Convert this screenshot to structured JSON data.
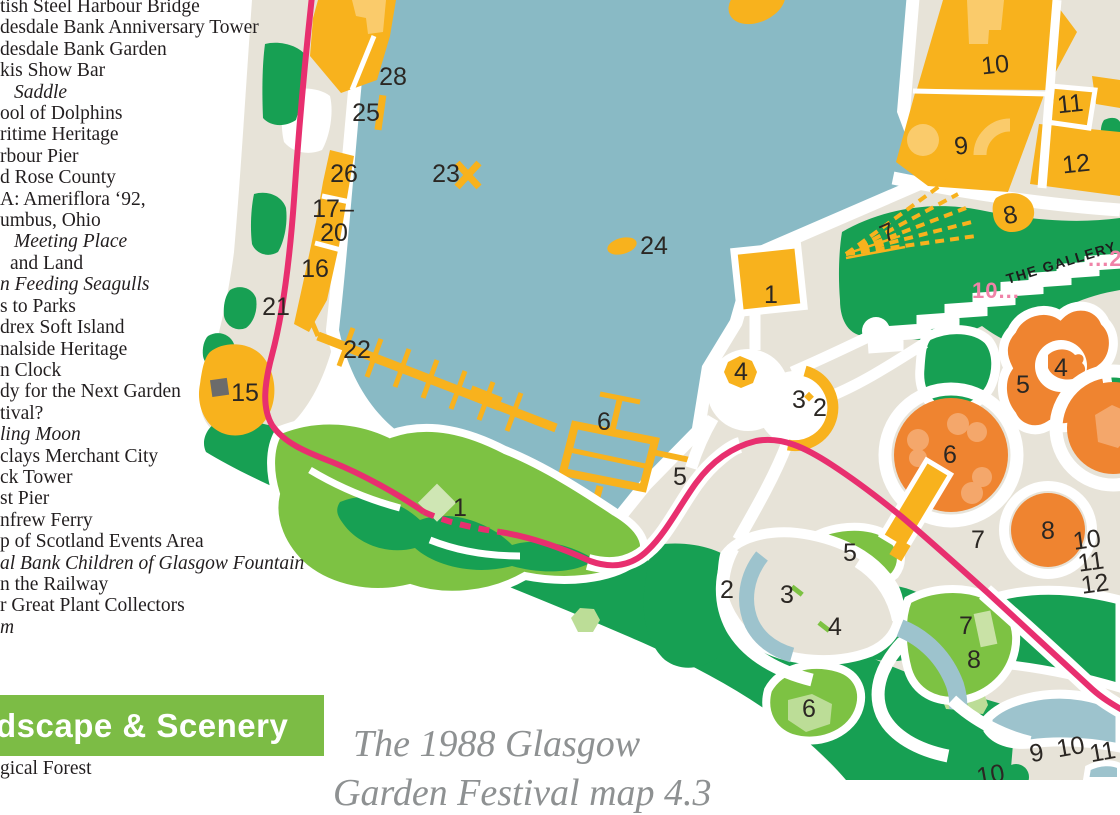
{
  "legend": {
    "items": [
      {
        "text": "tish Steel Harbour Bridge",
        "italic": false,
        "indent": 0
      },
      {
        "text": "desdale Bank Anniversary Tower",
        "italic": false,
        "indent": 0
      },
      {
        "text": "desdale Bank Garden",
        "italic": false,
        "indent": 0
      },
      {
        "text": "kis Show Bar",
        "italic": false,
        "indent": 0
      },
      {
        "text": "Saddle",
        "italic": true,
        "indent": 14
      },
      {
        "text": "ool of Dolphins",
        "italic": false,
        "indent": 0
      },
      {
        "text": "ritime Heritage",
        "italic": false,
        "indent": 0
      },
      {
        "text": "rbour Pier",
        "italic": false,
        "indent": 0
      },
      {
        "text": "d Rose County",
        "italic": false,
        "indent": 0
      },
      {
        "text": "A: Ameriflora ‘92,",
        "italic": false,
        "indent": 0
      },
      {
        "text": "umbus, Ohio",
        "italic": false,
        "indent": 0
      },
      {
        "text": "Meeting Place",
        "italic": true,
        "indent": 14
      },
      {
        "text": "and Land",
        "italic": false,
        "indent": 10
      },
      {
        "text": "n Feeding Seagulls",
        "italic": true,
        "indent": 0
      },
      {
        "text": "s to Parks",
        "italic": false,
        "indent": 0
      },
      {
        "text": "drex Soft Island",
        "italic": false,
        "indent": 0
      },
      {
        "text": "nalside Heritage",
        "italic": false,
        "indent": 0
      },
      {
        "text": "n Clock",
        "italic": false,
        "indent": 0
      },
      {
        "text": "dy for the Next Garden",
        "italic": false,
        "indent": 0
      },
      {
        "text": "tival?",
        "italic": false,
        "indent": 0
      },
      {
        "text": "ling Moon",
        "italic": true,
        "indent": 0
      },
      {
        "text": "clays Merchant City",
        "italic": false,
        "indent": 0
      },
      {
        "text": "ck Tower",
        "italic": false,
        "indent": 0
      },
      {
        "text": "st Pier",
        "italic": false,
        "indent": 0
      },
      {
        "text": "nfrew Ferry",
        "italic": false,
        "indent": 0
      },
      {
        "text": "p of Scotland Events Area",
        "italic": false,
        "indent": 0
      },
      {
        "text": "al Bank Children of Glasgow Fountain",
        "italic": true,
        "indent": 0
      },
      {
        "text": "n the Railway",
        "italic": false,
        "indent": 0
      },
      {
        "text": "r Great Plant Collectors",
        "italic": false,
        "indent": 0
      },
      {
        "text": "m",
        "italic": true,
        "indent": 0
      }
    ],
    "section_header": "dscape & Scenery",
    "below_item": "gical Forest"
  },
  "caption": {
    "line1": "The 1988 Glasgow",
    "line2": "Garden Festival map 4.3"
  },
  "map": {
    "texts": {
      "gallery": "THE GALLERY",
      "pink_left": "10...",
      "pink_right": "...25"
    },
    "labels": [
      {
        "t": "28",
        "x": 393,
        "y": 85,
        "r": 0
      },
      {
        "t": "25",
        "x": 366,
        "y": 121,
        "r": 0
      },
      {
        "t": "26",
        "x": 344,
        "y": 182,
        "r": 0
      },
      {
        "t": "17–",
        "x": 333,
        "y": 217,
        "r": 0
      },
      {
        "t": "20",
        "x": 334,
        "y": 241,
        "r": 0
      },
      {
        "t": "16",
        "x": 315,
        "y": 277,
        "r": 0
      },
      {
        "t": "21",
        "x": 276,
        "y": 315,
        "r": 0
      },
      {
        "t": "22",
        "x": 357,
        "y": 358,
        "r": 0
      },
      {
        "t": "15",
        "x": 245,
        "y": 401,
        "r": 0
      },
      {
        "t": "23",
        "x": 446,
        "y": 182,
        "r": 0
      },
      {
        "t": "24",
        "x": 654,
        "y": 254,
        "r": 0
      },
      {
        "t": "1",
        "x": 771,
        "y": 303,
        "r": 0
      },
      {
        "t": "4",
        "x": 741,
        "y": 380,
        "r": 0
      },
      {
        "t": "3",
        "x": 799,
        "y": 408,
        "r": 0
      },
      {
        "t": "2",
        "x": 820,
        "y": 416,
        "r": 0
      },
      {
        "t": "5",
        "x": 680,
        "y": 485,
        "r": 0
      },
      {
        "t": "6",
        "x": 604,
        "y": 430,
        "r": 0
      },
      {
        "t": "1",
        "x": 460,
        "y": 516,
        "r": 0
      },
      {
        "t": "7",
        "x": 891,
        "y": 240,
        "r": -24
      },
      {
        "t": "8",
        "x": 1012,
        "y": 223,
        "r": -12
      },
      {
        "t": "10",
        "x": 996,
        "y": 73,
        "r": -6
      },
      {
        "t": "9",
        "x": 962,
        "y": 154,
        "r": -6
      },
      {
        "t": "11",
        "x": 1071,
        "y": 112,
        "r": -6
      },
      {
        "t": "12",
        "x": 1077,
        "y": 172,
        "r": -6
      },
      {
        "t": "5",
        "x": 1023,
        "y": 393,
        "r": 0
      },
      {
        "t": "4",
        "x": 1061,
        "y": 376,
        "r": 0
      },
      {
        "t": "6",
        "x": 950,
        "y": 463,
        "r": 0
      },
      {
        "t": "8",
        "x": 1048,
        "y": 539,
        "r": 0
      },
      {
        "t": "7",
        "x": 978,
        "y": 548,
        "r": 0
      },
      {
        "t": "10",
        "x": 1088,
        "y": 548,
        "r": -8
      },
      {
        "t": "11",
        "x": 1092,
        "y": 570,
        "r": -8
      },
      {
        "t": "12",
        "x": 1096,
        "y": 592,
        "r": -8
      },
      {
        "t": "2",
        "x": 727,
        "y": 598,
        "r": 0
      },
      {
        "t": "3",
        "x": 787,
        "y": 603,
        "r": 0
      },
      {
        "t": "4",
        "x": 835,
        "y": 635,
        "r": 0
      },
      {
        "t": "5",
        "x": 850,
        "y": 561,
        "r": 0
      },
      {
        "t": "6",
        "x": 809,
        "y": 717,
        "r": 0
      },
      {
        "t": "7",
        "x": 966,
        "y": 634,
        "r": 0
      },
      {
        "t": "8",
        "x": 974,
        "y": 668,
        "r": 0
      },
      {
        "t": "9",
        "x": 1038,
        "y": 761,
        "r": -10
      },
      {
        "t": "10",
        "x": 1072,
        "y": 755,
        "r": -10
      },
      {
        "t": "11",
        "x": 1104,
        "y": 760,
        "r": -10
      },
      {
        "t": "10",
        "x": 992,
        "y": 783,
        "r": -10
      }
    ],
    "colors": {
      "water": "#89BAC5",
      "water_light": "#9DC3CD",
      "land": "#E7E3D8",
      "green_dark": "#17A053",
      "green_light": "#7DC243",
      "green_pale": "#BCDD97",
      "amber": "#F8B21D",
      "amber_light": "#FACB6B",
      "orange": "#EF8430",
      "orange_light": "#F4A76B",
      "route_pink": "#E82F6F",
      "pink_text": "#F083A8",
      "label": "#2B2723",
      "gray_marker": "#6B6B6B",
      "banner_green": "#7CBC45",
      "caption_gray": "#8E9192",
      "text_dark": "#221E1F"
    }
  }
}
